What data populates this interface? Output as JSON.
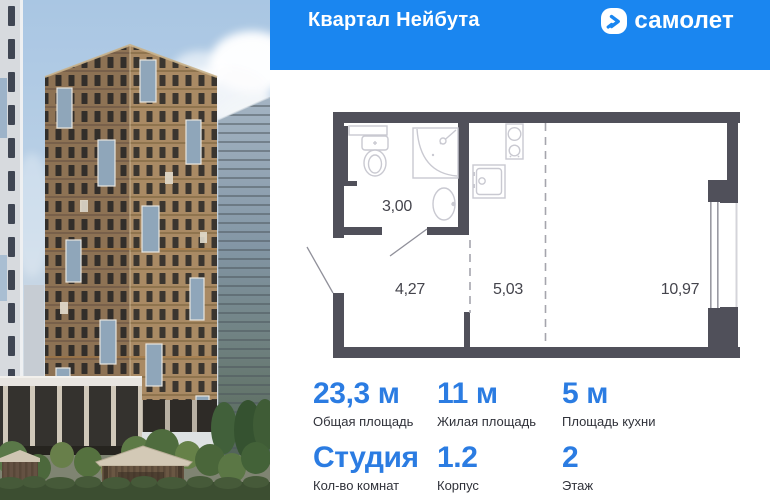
{
  "header": {
    "project_title": "Квартал Нейбута",
    "brand": "самолет",
    "bg_color": "#1a86f0"
  },
  "floor_plan": {
    "wall_color": "#50505a",
    "rooms": [
      {
        "name": "bathroom",
        "area": "3,00"
      },
      {
        "name": "hallway",
        "area": "4,27"
      },
      {
        "name": "kitchen",
        "area": "5,03"
      },
      {
        "name": "living-room",
        "area": "10,97"
      }
    ]
  },
  "stats": {
    "value_color": "#2b7ce2",
    "items": [
      {
        "value": "23,3 м",
        "label": "Общая площадь"
      },
      {
        "value": "11 м",
        "label": "Жилая площадь"
      },
      {
        "value": "5 м",
        "label": "Площадь кухни"
      },
      {
        "value": "Студия",
        "label": "Кол-во комнат"
      },
      {
        "value": "1.2",
        "label": "Корпус"
      },
      {
        "value": "2",
        "label": "Этаж"
      }
    ]
  }
}
